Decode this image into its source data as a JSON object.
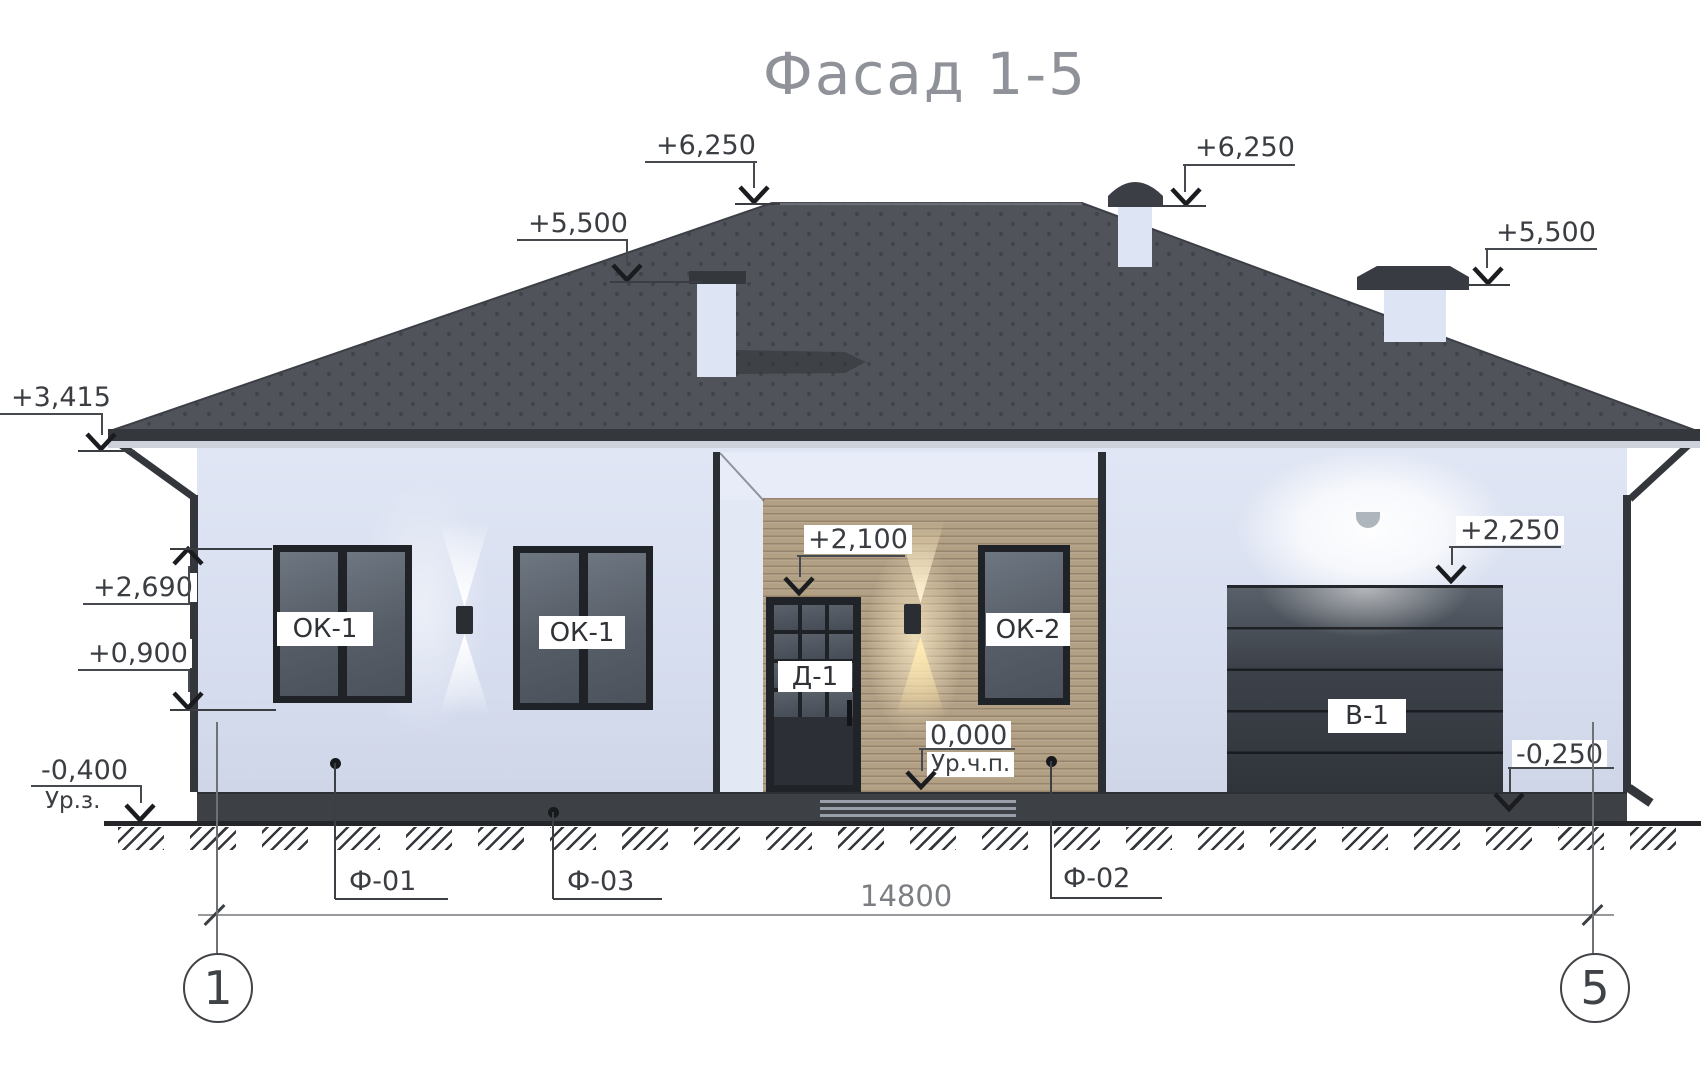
{
  "title": "Фасад 1-5",
  "elevation_marks": [
    {
      "id": "ridge-left",
      "text": "+6,250"
    },
    {
      "id": "chimney-right",
      "text": "+6,250"
    },
    {
      "id": "chimney-left",
      "text": "+5,500"
    },
    {
      "id": "chimney-far-right",
      "text": "+5,500"
    },
    {
      "id": "eave-left",
      "text": "+3,415"
    },
    {
      "id": "window-head",
      "text": "+2,690"
    },
    {
      "id": "window-sill",
      "text": "+0,900"
    },
    {
      "id": "door-head",
      "text": "+2,100"
    },
    {
      "id": "garage-head",
      "text": "+2,250"
    },
    {
      "id": "finished-floor",
      "text": "0,000",
      "sublabel": "Ур.ч.п."
    },
    {
      "id": "ground-level",
      "text": "-0,400",
      "sublabel": "Ур.з."
    },
    {
      "id": "garage-apron",
      "text": "-0,250"
    }
  ],
  "component_labels": {
    "window1": "ОК-1",
    "window2": "ОК-1",
    "window3": "ОК-2",
    "door": "Д-1",
    "garage_door": "В-1"
  },
  "foundation_callouts": [
    {
      "text": "Ф-01"
    },
    {
      "text": "Ф-03"
    },
    {
      "text": "Ф-02"
    }
  ],
  "dimension": {
    "total_width": "14800"
  },
  "axes": [
    {
      "number": "1"
    },
    {
      "number": "5"
    }
  ],
  "colors": {
    "roof": "#50545a",
    "roof_dot": "#3f434a",
    "wall": "#d9e0f0",
    "wood_siding": "#b2a085",
    "dark_joinery": "#26292e",
    "glass": "#5a616b",
    "annotation": "#3a3d41"
  }
}
